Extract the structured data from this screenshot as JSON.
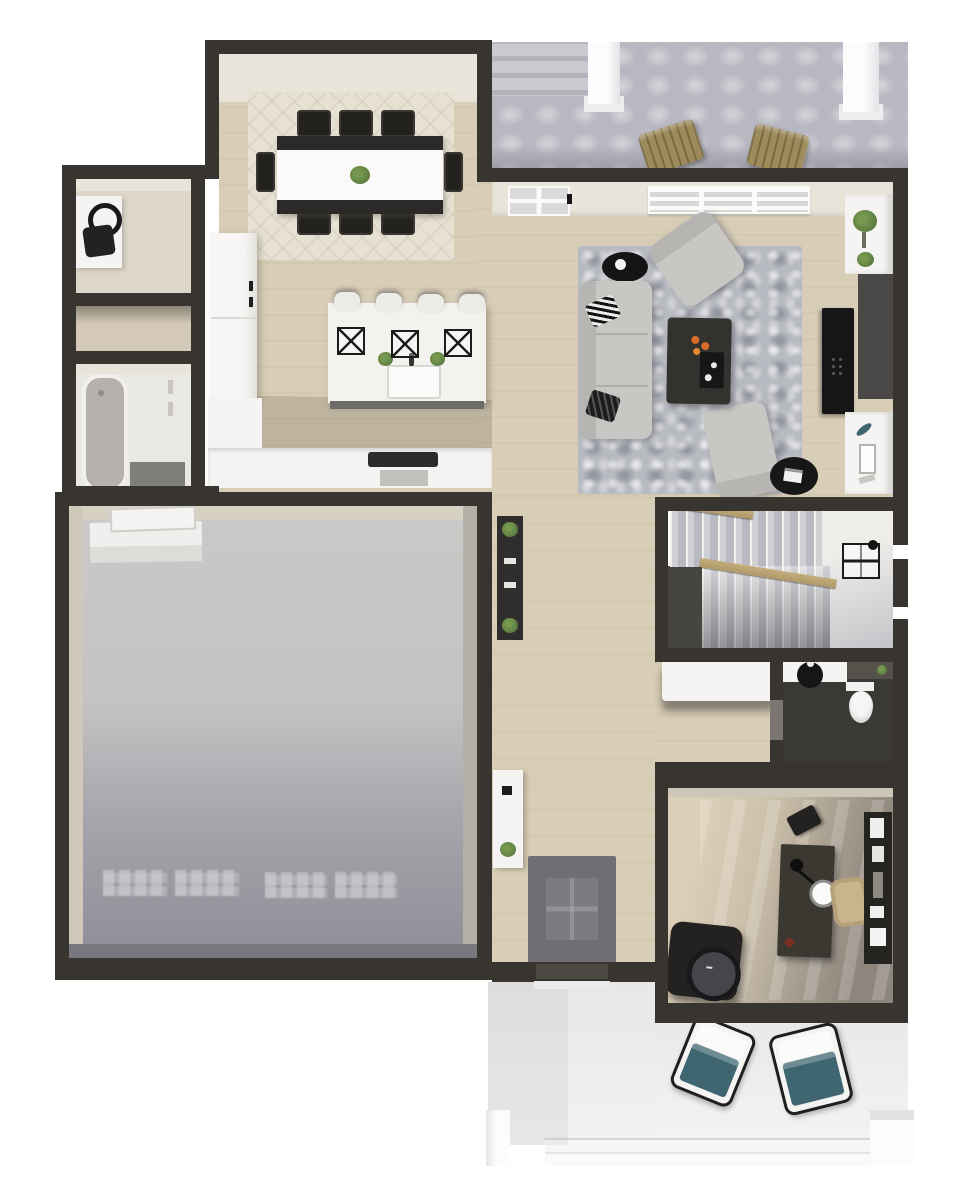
{
  "scene": {
    "description": "Top-down 3D rendered floor plan of a home's first floor on a white background",
    "background": "#ffffff",
    "visible_text": "none"
  },
  "colors": {
    "wall_dark": "#383531",
    "wall_inner_light": "#e9e4d9",
    "wood_floor": "#d8cdb6",
    "garage_inner_wall": "#d7d1c4",
    "deck_concrete": "#b7b8c1",
    "porch_concrete": "#efeff0",
    "rug_dining": "#e7e1d3",
    "rug_living": "#b8bac1",
    "rug_entry": "#6f6e73",
    "sofa_gray": "#c9c7c3",
    "furniture_dark": "#2d2b29",
    "counter_white": "#f5f4f2",
    "accent_wood": "#af9869",
    "adirondack_wood": "#9d8b5c",
    "cushion_teal": "#3e6570",
    "plant_green": "#5d7d42",
    "tv_black": "#161616",
    "candle_orange": "#d96d2a",
    "office_chair_tan": "#c9b48d",
    "tub_gray": "#b4b1ae"
  },
  "rooms": [
    {
      "id": "rear-deck",
      "contents": [
        "concrete-steps",
        "white-column",
        "white-column",
        "adirondack-chair",
        "adirondack-chair"
      ]
    },
    {
      "id": "dining-room",
      "contents": [
        "transom-window",
        "patterned-area-rug",
        "trestle-dining-table",
        "eight-dining-chairs",
        "plant-centerpiece",
        "wall-art"
      ]
    },
    {
      "id": "kitchen",
      "contents": [
        "refrigerator-tall-cabinets",
        "perimeter-counter",
        "range-cooktop",
        "island",
        "four-bar-stools",
        "three-cage-pendant-lights",
        "farmhouse-sink",
        "faucet",
        "two-potted-herbs"
      ]
    },
    {
      "id": "living-room",
      "contents": [
        "window-band",
        "transom-vent",
        "sofa",
        "striped-pillows",
        "round-black-side-table",
        "accent-armchair",
        "accent-armchair",
        "round-ottoman-with-tray",
        "coffee-table",
        "candles",
        "fireplace-surround",
        "flat-screen-tv",
        "built-in-cabinet-with-plant",
        "built-in-cabinet-with-decor",
        "shag-area-rug"
      ]
    },
    {
      "id": "laundry-room",
      "contents": [
        "white-counter",
        "dark-utility-fixture"
      ]
    },
    {
      "id": "hall-closet",
      "contents": []
    },
    {
      "id": "bathroom",
      "contents": [
        "bathtub",
        "open-door-shadow"
      ]
    },
    {
      "id": "garage",
      "contents": [
        "attic-hatch-panel",
        "entry-step",
        "garage-door-light-reflections"
      ]
    },
    {
      "id": "hallway",
      "contents": [
        "dark-console-table",
        "two-plants",
        "white-entry-console",
        "plant",
        "dark-entry-rug",
        "front-door",
        "threshold"
      ]
    },
    {
      "id": "staircase",
      "contents": [
        "upper-flight",
        "landing",
        "lower-flight",
        "wood-handrails",
        "wire-cubby-organizer"
      ]
    },
    {
      "id": "mudroom-nook",
      "contents": [
        "white-bench"
      ]
    },
    {
      "id": "powder-room",
      "contents": [
        "white-vanity",
        "black-vessel-sink",
        "faucet",
        "toilet",
        "dark-counter",
        "green-soap"
      ]
    },
    {
      "id": "office",
      "contents": [
        "dark-desk",
        "desk-lamp",
        "tan-office-chair",
        "black-stool",
        "dark-lounge-chair",
        "round-cushion",
        "bookshelf-with-decor",
        "red-accent"
      ]
    },
    {
      "id": "front-porch",
      "contents": [
        "lounge-chair-teal-cushion",
        "lounge-chair-teal-cushion",
        "steps",
        "white-post",
        "white-post"
      ]
    }
  ]
}
